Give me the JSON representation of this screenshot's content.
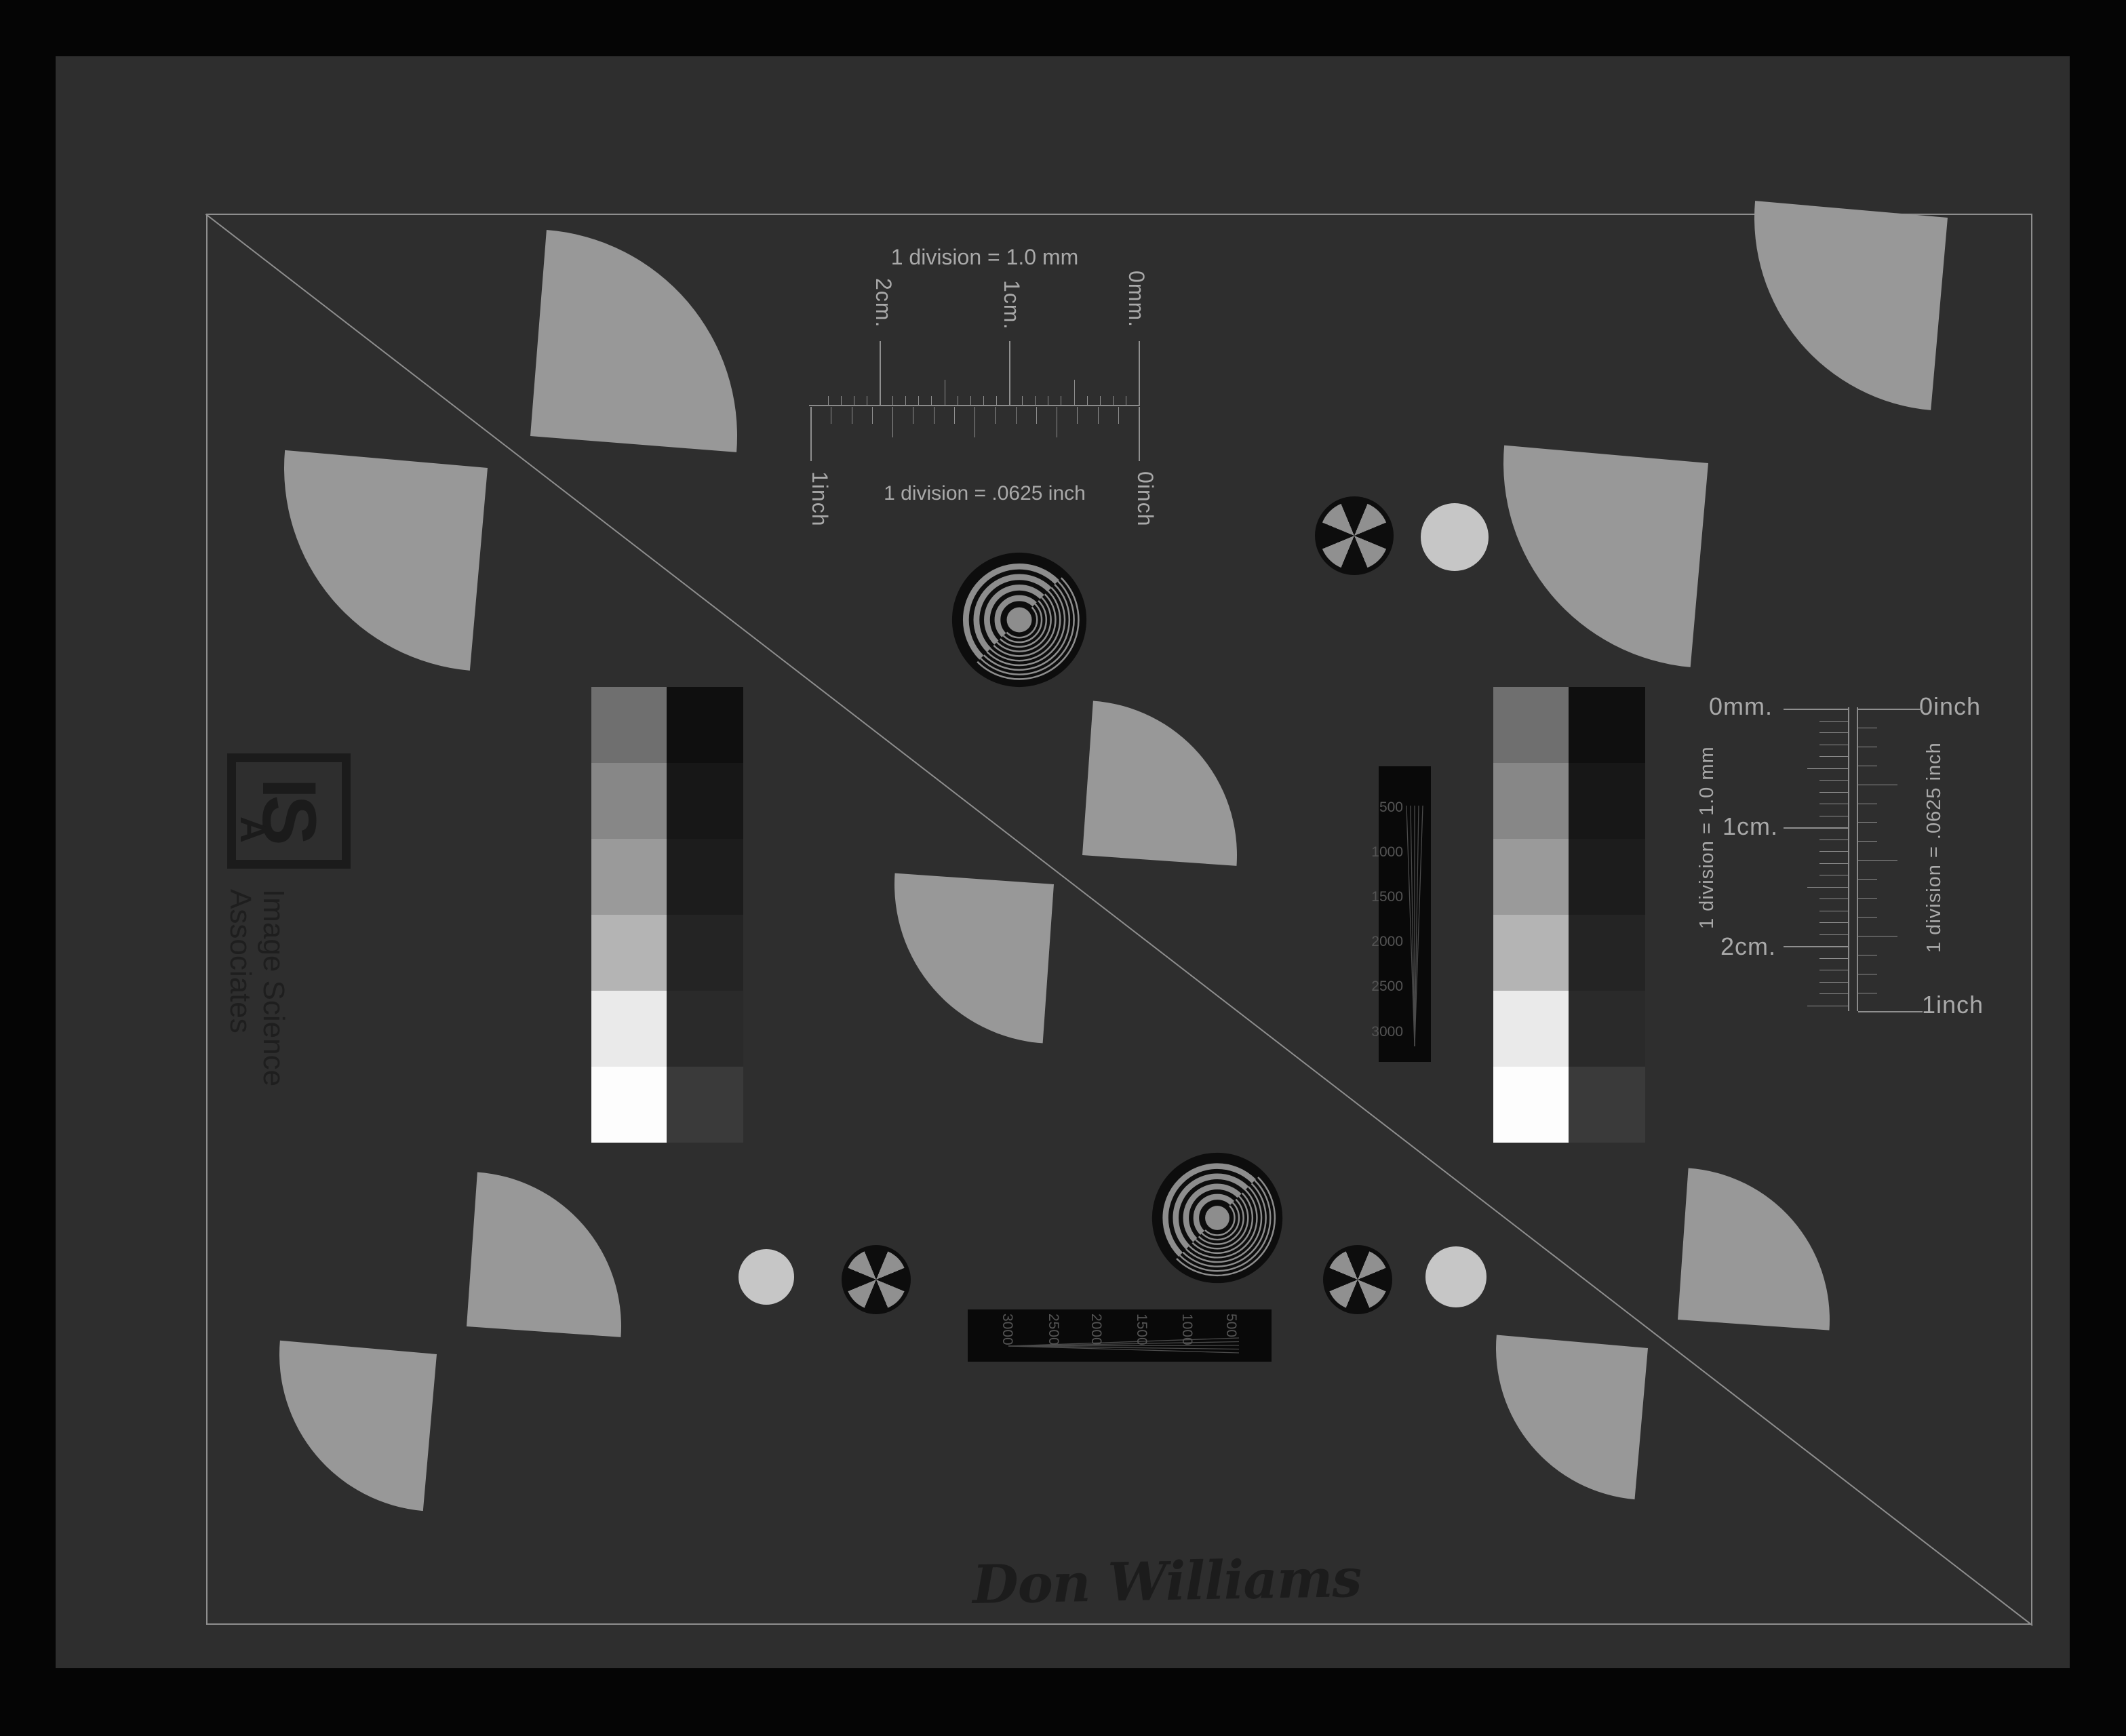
{
  "signature": "Don Williams",
  "logo": {
    "initials_main": "IS",
    "initials_sub": "A",
    "name_line1": "Image Science",
    "name_line2": "Associates"
  },
  "rulers": {
    "top": {
      "mm_title": "1 division = 1.0 mm",
      "inch_title": "1 division = .0625 inch",
      "label_2cm": "2cm.",
      "label_1cm": "1cm.",
      "label_0mm": "0mm.",
      "label_1inch": "1inch",
      "label_0inch": "0inch"
    },
    "right": {
      "mm_title": "1 division = 1.0 mm",
      "inch_title": "1 division = .0625 inch",
      "label_0mm": "0mm.",
      "label_0inch": "0inch",
      "label_1cm": "1cm.",
      "label_2cm": "2cm.",
      "label_1inch": "1inch"
    }
  },
  "resolution_wedges": {
    "vertical_labels": [
      "500",
      "1000",
      "1500",
      "2000",
      "2500",
      "3000"
    ],
    "horizontal_labels": [
      "3000",
      "2500",
      "2000",
      "1500",
      "1000",
      "500"
    ]
  },
  "grayscale": {
    "left_column": [
      "#6f6f6f",
      "#878787",
      "#9a9a9a",
      "#b4b4b4",
      "#eaeaea",
      "#fdfdfd"
    ],
    "right_column": [
      "#0f0f0f",
      "#171717",
      "#1c1c1c",
      "#242424",
      "#2a2a2a",
      "#3a3a3a"
    ]
  },
  "colors": {
    "scan_background": "#050505",
    "card_background": "#2e2e2e",
    "frame_line": "#8e8e8e",
    "fan_gray": "#989898",
    "light_circle": "#c6c6c6",
    "target_black": "#0d0d0d",
    "target_ring_gray": "#8d8d8d",
    "ruler_text": "#a9a9a9",
    "dark_ink": "#1c1c1c",
    "wedge_line": "#4a4a4a"
  }
}
